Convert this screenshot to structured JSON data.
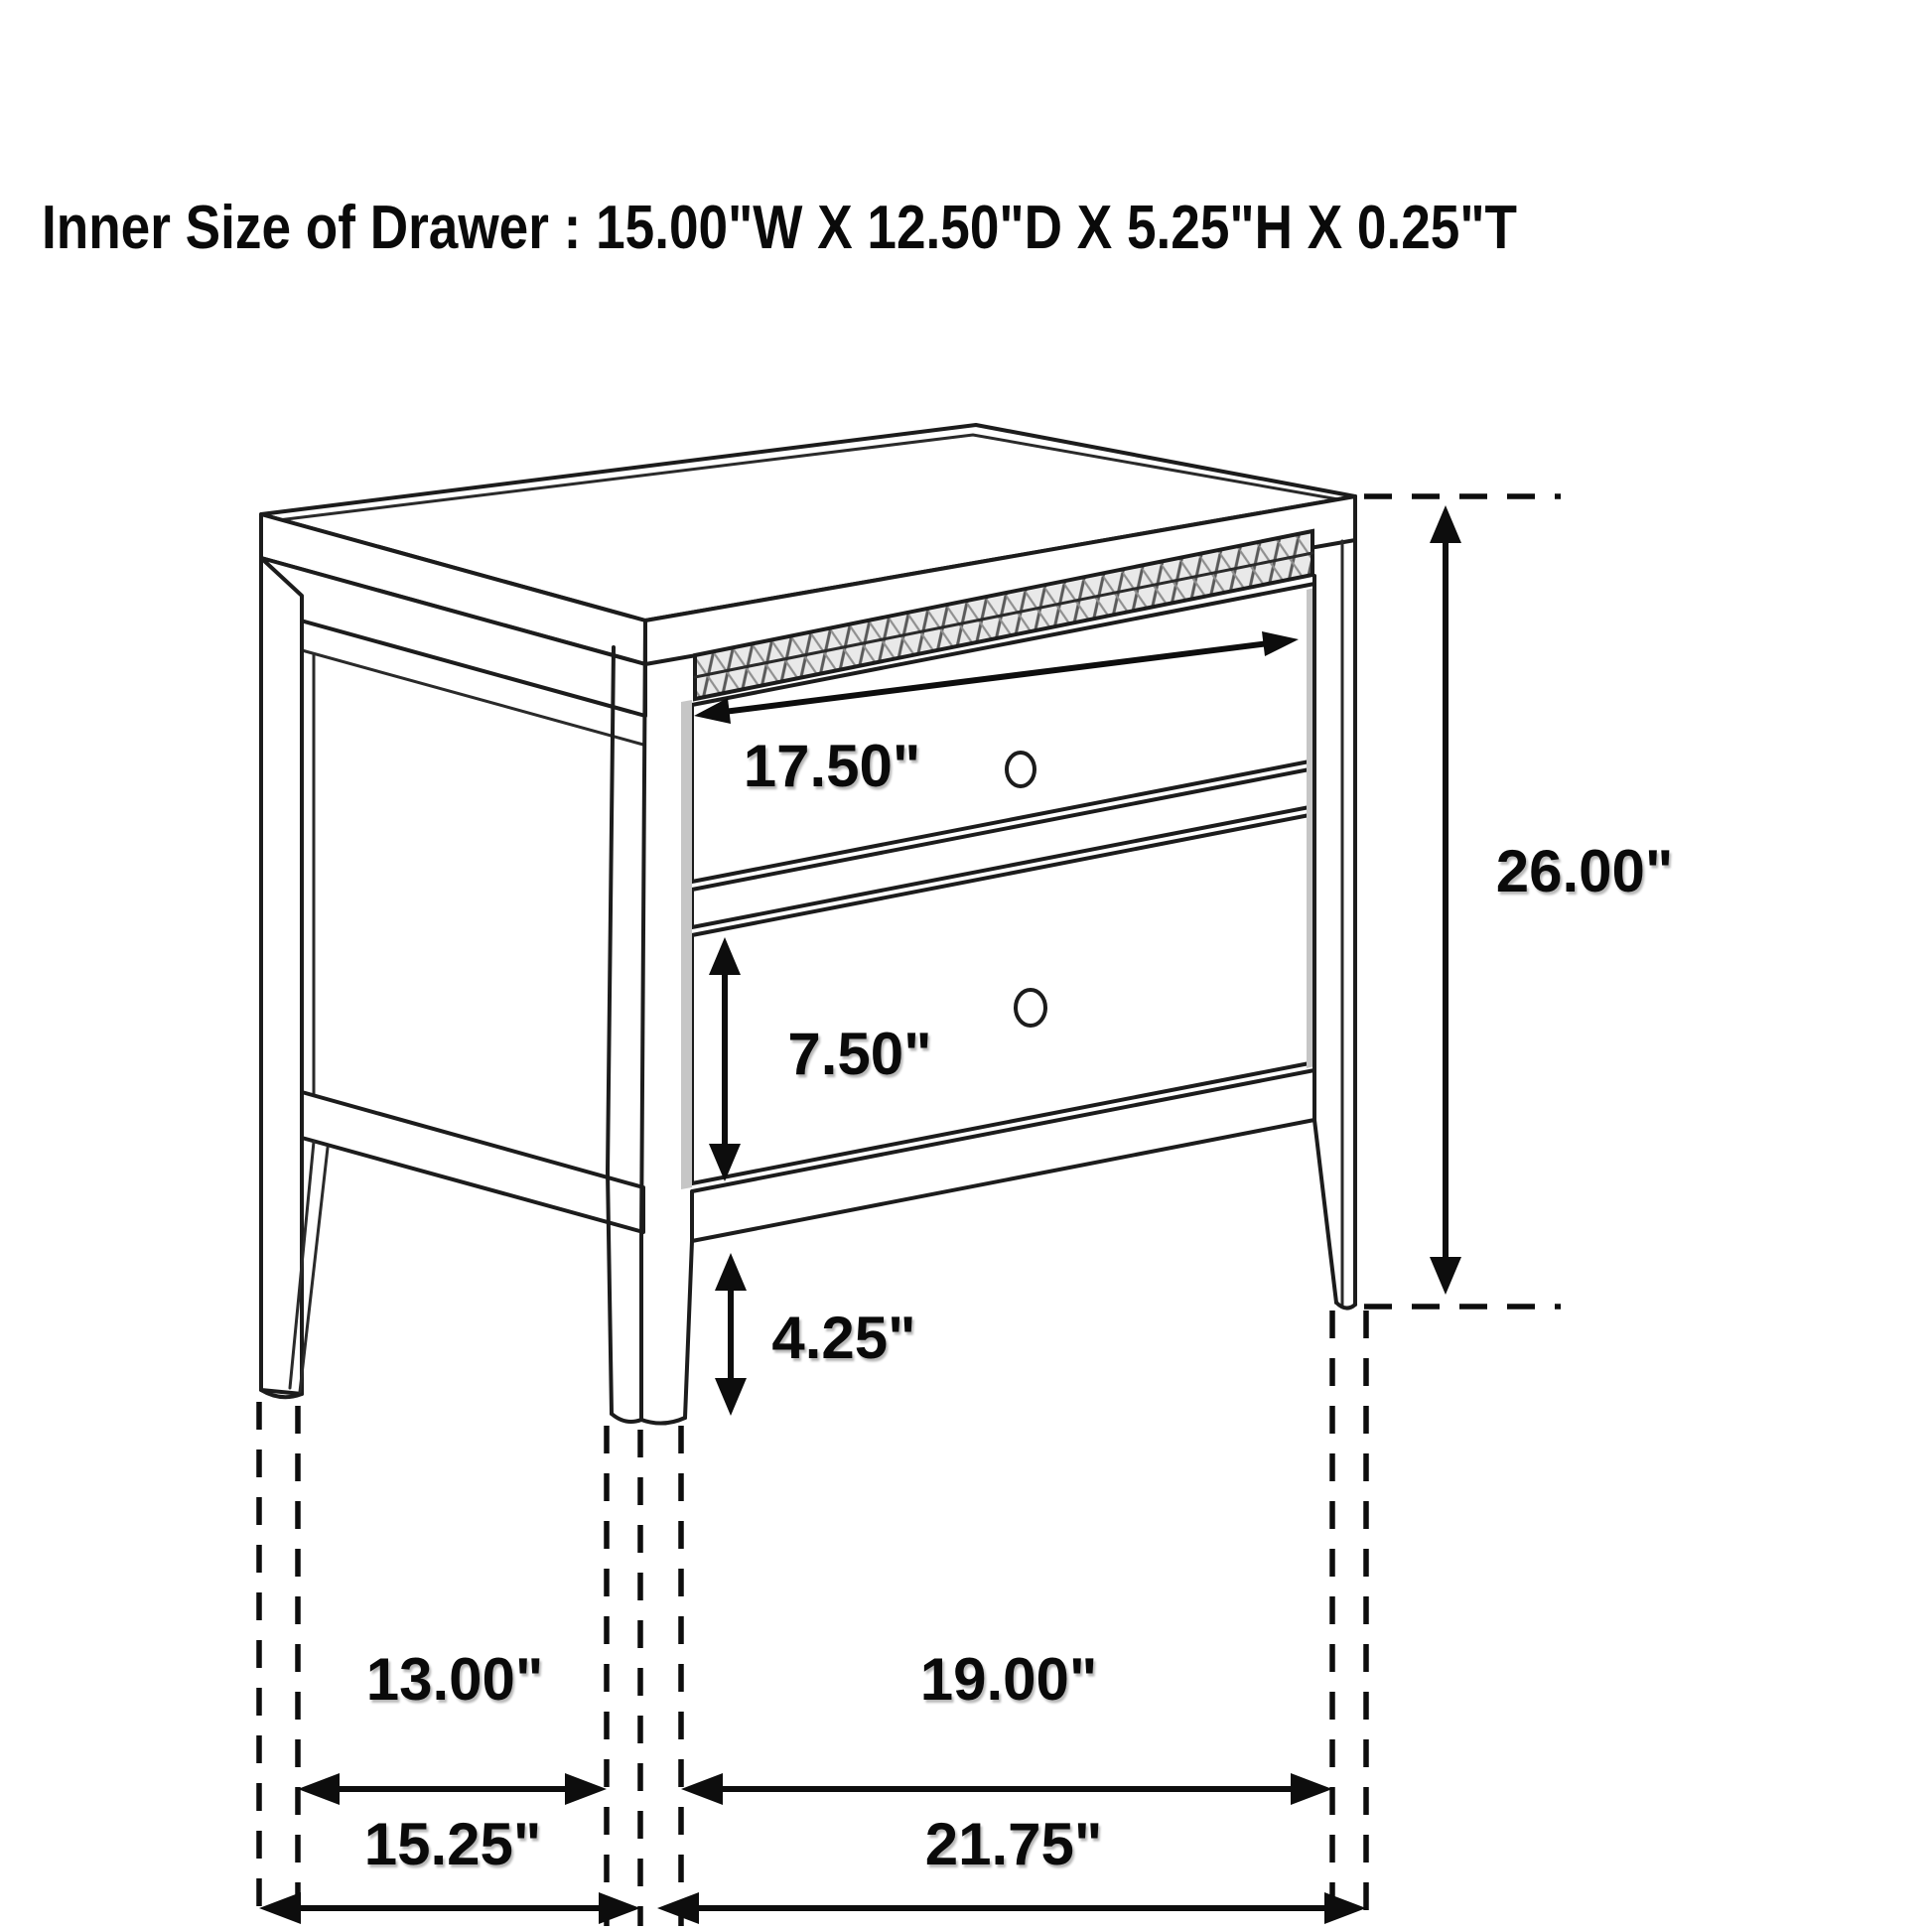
{
  "title": "Inner Size of Drawer : 15.00\"W X 12.50\"D X 5.25\"H X 0.25\"T",
  "inner_drawer_specs": {
    "width": "15.00\"W",
    "depth": "12.50\"D",
    "height": "5.25\"H",
    "thickness": "0.25\"T"
  },
  "diagram": {
    "type": "furniture-dimension-drawing",
    "subject": "two-drawer nightstand perspective line drawing",
    "line_color": "#1c1c1c",
    "background": "#ffffff",
    "drawer_count": 2,
    "dims": {
      "top_drawer_width": "17.50\"",
      "overall_height": "26.00\"",
      "bottom_drawer_height": "7.50\"",
      "leg_height": "4.25\"",
      "side_inner_depth": "13.00\"",
      "front_inner_width": "19.00\"",
      "side_overall_depth": "15.25\"",
      "front_overall_width": "21.75\""
    }
  }
}
